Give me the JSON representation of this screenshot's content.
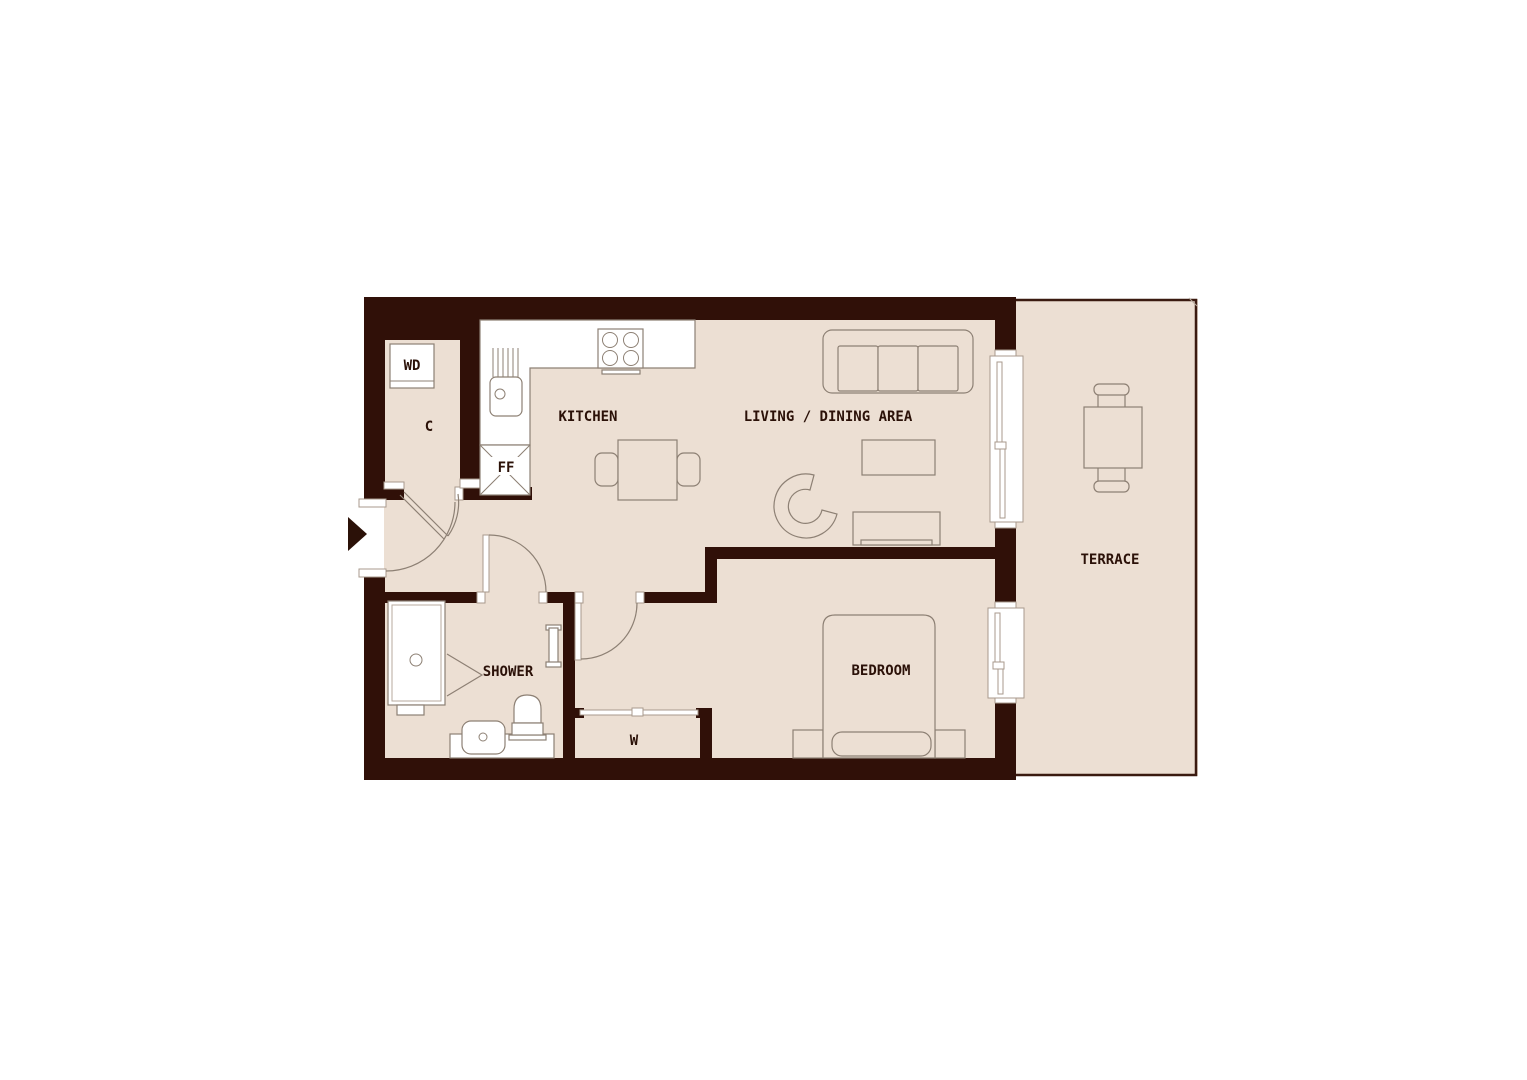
{
  "labels": {
    "closet": "C",
    "washer_dryer": "WD",
    "fridge_freezer": "FF",
    "kitchen": "KITCHEN",
    "living_dining": "LIVING / DINING AREA",
    "terrace": "TERRACE",
    "shower": "SHOWER",
    "wardrobe": "W",
    "bedroom": "BEDROOM"
  },
  "rooms": [
    {
      "id": "closet",
      "label": "C"
    },
    {
      "id": "kitchen",
      "label": "KITCHEN"
    },
    {
      "id": "living_dining",
      "label": "LIVING / DINING AREA"
    },
    {
      "id": "terrace",
      "label": "TERRACE"
    },
    {
      "id": "shower",
      "label": "SHOWER"
    },
    {
      "id": "wardrobe",
      "label": "W"
    },
    {
      "id": "bedroom",
      "label": "BEDROOM"
    }
  ],
  "icons": {
    "entry_arrow": "solid right-pointing triangle marking apartment entrance"
  },
  "colors": {
    "wall": "#301008",
    "floor": "#ecdfd3",
    "outline": "#8d8074",
    "fixture": "#ffffff",
    "label": "#2b1108",
    "jamb": "#a89a8c",
    "terrace_border": "#3a1a10",
    "background": "#ffffff"
  }
}
